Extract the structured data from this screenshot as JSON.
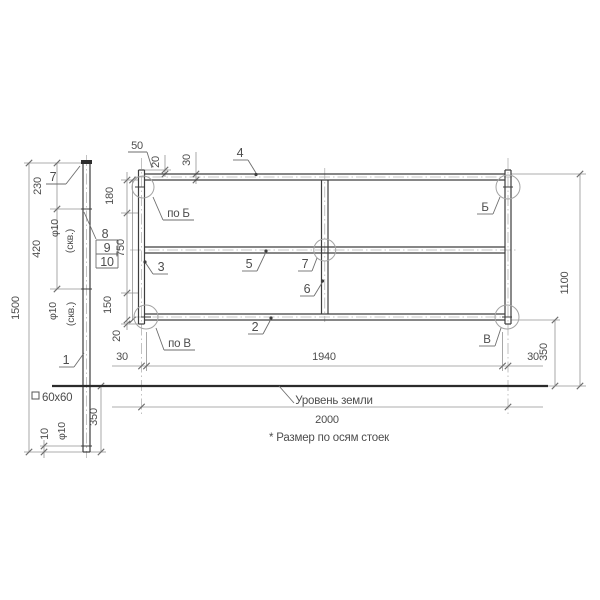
{
  "side": {
    "item1": "1",
    "item7": "7",
    "item8": "8",
    "item9": "9",
    "item10": "10",
    "height": "1500",
    "topToHole": "230",
    "holeSpacing": "420",
    "hole1Dia": "φ10",
    "hole1Thru": "(скв.)",
    "hole2Dia": "φ10",
    "hole2Thru": "(скв.)",
    "embedDepth": "350",
    "bottomOffset": "10",
    "bottomHoleDia": "φ10",
    "profile": "60x60"
  },
  "front": {
    "item2": "2",
    "item3": "3",
    "item4": "4",
    "item5": "5",
    "item6": "6",
    "item7": "7",
    "viewB": "по Б",
    "markerB": "Б",
    "viewV": "по В",
    "markerV": "В",
    "topTotal": "50",
    "topOffset": "20",
    "railHeight": "30",
    "railToHole": "180",
    "clearHeight": "750",
    "holeToRail": "150",
    "bottomOffset": "20",
    "leftEnd": "30",
    "clearLength": "1940",
    "rightEnd": "30",
    "railToGround": "350",
    "aboveGround": "1100",
    "axesSpan": "2000"
  },
  "notes": {
    "groundLevel": "Уровень земли",
    "axesNote": "* Размер по осям стоек"
  }
}
